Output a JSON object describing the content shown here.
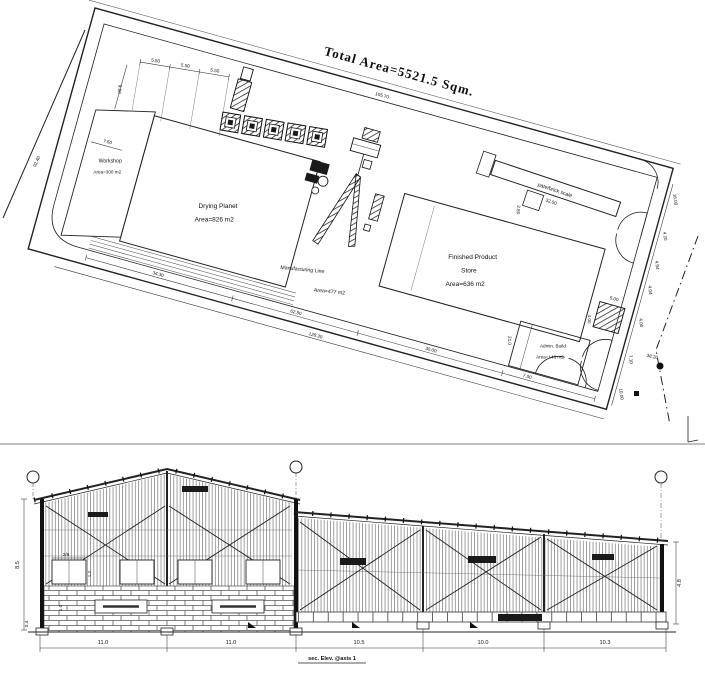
{
  "site": {
    "title": "Total Area=5521.5 Sqm.",
    "workshop_name": "Workshop",
    "workshop_area": "Area=300 m2",
    "drying_name": "Drying Planet",
    "drying_area": "Area=826 m2",
    "mfg_name": "Manufacturing Line",
    "mfg_area": "Area=477 m2",
    "store_name1": "Finished Product",
    "store_name2": "Store",
    "store_area": "Area=636 m2",
    "admin_name": "Admin. Build",
    "admin_area": "Area=146 m2",
    "scale_name": "pate/brick scale",
    "dims": {
      "d550a": "5.50",
      "d550b": "5.50",
      "d550c": "5.50",
      "d900": "9.00",
      "d750": "7.50",
      "d9240": "92.40",
      "d10570": "105.70",
      "d3430": "34.30",
      "d6250": "62.50",
      "d3000": "30.00",
      "d700": "7.00",
      "d12630": "126.30",
      "d1600": "16.00",
      "d420": "4.20",
      "d494": "4.94",
      "d404": "4.04",
      "d400": "4.00",
      "d710": "7.10",
      "d1000": "10.00",
      "d210": "21.0",
      "d500": "5.00",
      "d3200": "32.00",
      "d280": "2.80",
      "spot": "38.20"
    }
  },
  "elev": {
    "b1": "11.0",
    "b2": "11.0",
    "b3": "10.5",
    "b4": "10.0",
    "b5": "10.3",
    "h_left": "8.5",
    "h_right": "4.8",
    "h_base": "0.4",
    "w26": "2/6",
    "w12": "1.2",
    "w10": "1.0",
    "caption": "sec. Elev. @axis 1"
  }
}
